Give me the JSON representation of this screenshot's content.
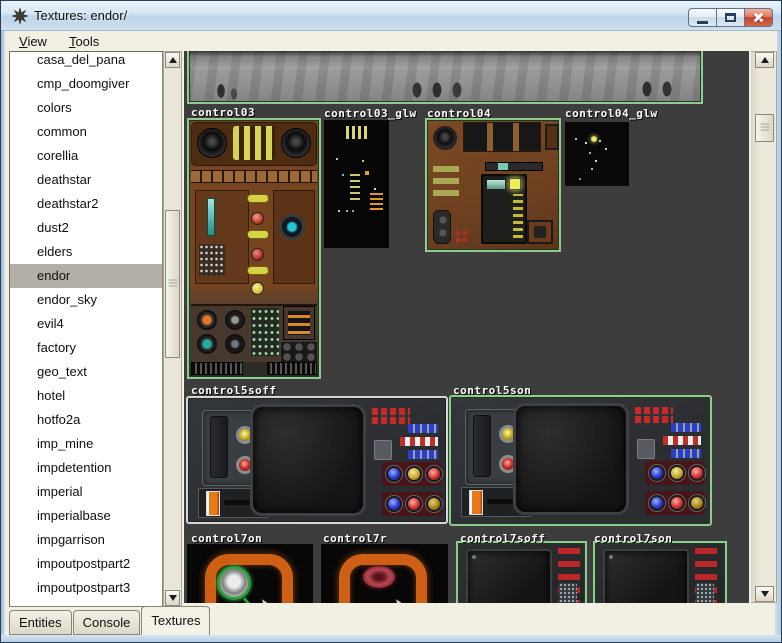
{
  "window": {
    "title": "Textures: endor/",
    "icon": "radiant-star-icon",
    "controls": [
      "minimize",
      "maximize",
      "close"
    ]
  },
  "menubar": {
    "items": [
      {
        "label": "View",
        "underline": "V"
      },
      {
        "label": "Tools",
        "underline": "T"
      }
    ]
  },
  "sidebar": {
    "selected": "endor",
    "items": [
      {
        "label": "casa_del_pana"
      },
      {
        "label": "cmp_doomgiver"
      },
      {
        "label": "colors"
      },
      {
        "label": "common"
      },
      {
        "label": "corellia"
      },
      {
        "label": "deathstar"
      },
      {
        "label": "deathstar2"
      },
      {
        "label": "dust2"
      },
      {
        "label": "elders"
      },
      {
        "label": "endor",
        "selected": true
      },
      {
        "label": "endor_sky"
      },
      {
        "label": "evil4"
      },
      {
        "label": "factory"
      },
      {
        "label": "geo_text"
      },
      {
        "label": "hotel"
      },
      {
        "label": "hotfo2a"
      },
      {
        "label": "imp_mine"
      },
      {
        "label": "impdetention"
      },
      {
        "label": "imperial"
      },
      {
        "label": "imperialbase"
      },
      {
        "label": "impgarrison"
      },
      {
        "label": "impoutpostpart2"
      },
      {
        "label": "impoutpostpart3"
      }
    ]
  },
  "textures": {
    "folder": "endor/",
    "tiles": [
      {
        "id": "strip-top",
        "label": "",
        "style": "tex-wall",
        "x": 3,
        "y": -8,
        "w": 516,
        "h": 61,
        "border": "green",
        "parts": [
          "p-wall-marks"
        ]
      },
      {
        "id": "control03",
        "label": "control03",
        "lx": 7,
        "ly": 55,
        "x": 3,
        "y": 67,
        "w": 134,
        "h": 261,
        "border": "green",
        "style": "tex-c03",
        "parts": [
          "p-c03-top",
          "p-c03-knob-l",
          "p-c03-knob-r",
          "p-c03-slats",
          "p-c03-cells",
          "p-c03-panel-l",
          "p-c03-teal",
          "p-c03-grid",
          "p-c03-pill1",
          "p-c03-dot1",
          "p-c03-pill2",
          "p-c03-dot2",
          "p-c03-pill3",
          "p-c03-dot3",
          "p-c03-panel-r",
          "p-c03-scope",
          "p-c03-low",
          "p-c03-ka",
          "p-c03-kb",
          "p-c03-kc",
          "p-c03-kd",
          "p-c03-ggrid",
          "p-c03-obox",
          "p-c03-circ6",
          "p-c03-vents",
          "p-c03-ventgap"
        ]
      },
      {
        "id": "control03_glw",
        "label": "control03_glw",
        "lx": 140,
        "ly": 56,
        "x": 140,
        "y": 69,
        "w": 65,
        "h": 128,
        "style": "tex-glw3",
        "parts": [
          "p-glw3-slats",
          "p-glw3-sp1",
          "p-glw3-orange",
          "p-glw3-bars"
        ]
      },
      {
        "id": "control04",
        "label": "control04",
        "lx": 243,
        "ly": 56,
        "x": 241,
        "y": 67,
        "w": 136,
        "h": 134,
        "border": "green",
        "style": "tex-c04",
        "parts": [
          "p-c04-knob",
          "p-c04-btnrow",
          "p-c04-btn4",
          "p-c04-bar",
          "p-c04-tags",
          "p-c04-module",
          "p-c04-mscreen",
          "p-c04-ylight",
          "p-c04-mrows",
          "p-c04-side",
          "p-c04-botbox",
          "p-c04-dots"
        ]
      },
      {
        "id": "control04_glw",
        "label": "control04_glw",
        "lx": 381,
        "ly": 56,
        "x": 381,
        "y": 71,
        "w": 64,
        "h": 64,
        "style": "tex-glw4",
        "parts": [
          "p-glw4-sp",
          "p-glw4-center"
        ]
      },
      {
        "id": "control5soff",
        "label": "control5soff",
        "lx": 7,
        "ly": 333,
        "x": 2,
        "y": 345,
        "w": 262,
        "h": 128,
        "border": "gray",
        "style": "tex-c5",
        "parts": [
          "p-c5-tl",
          "p-c5-slot",
          "p-c5-by",
          "p-c5-br",
          "p-c5-lpanel",
          "p-c5-lever",
          "p-c5-lslot",
          "p-c5-screen",
          "p-c5-redgrid",
          "p-c5-chip",
          "p-c5-rb1",
          "p-c5-rw",
          "p-c5-rb2",
          "p-c5-plate1",
          "p-c5-b1",
          "p-c5-b2",
          "p-c5-b3",
          "p-c5-plate2",
          "p-c5-b4",
          "p-c5-b5",
          "p-c5-b6"
        ]
      },
      {
        "id": "control5son",
        "label": "control5son",
        "lx": 269,
        "ly": 333,
        "x": 265,
        "y": 344,
        "w": 263,
        "h": 131,
        "border": "green",
        "style": "tex-c5",
        "parts": [
          "p-c5-tl",
          "p-c5-slot",
          "p-c5-by",
          "p-c5-br",
          "p-c5-lpanel",
          "p-c5-lever",
          "p-c5-lslot",
          "p-c5-screen",
          "p-c5-redgrid",
          "p-c5-chip",
          "p-c5-rb1",
          "p-c5-rw",
          "p-c5-rb2",
          "p-c5-plate1",
          "p-c5-b1",
          "p-c5-b2",
          "p-c5-b3",
          "p-c5-plate2",
          "p-c5-b4",
          "p-c5-b5",
          "p-c5-b6"
        ]
      },
      {
        "id": "control7on",
        "label": "control7on",
        "lx": 7,
        "ly": 481,
        "x": 3,
        "y": 493,
        "w": 126,
        "h": 108,
        "style": "tex-c7on",
        "parts": [
          "p-c7-ring",
          "p-c7-lens",
          "p-c7-stem",
          "p-c7-cursor"
        ]
      },
      {
        "id": "control7r",
        "label": "control7r",
        "lx": 139,
        "ly": 481,
        "x": 137,
        "y": 493,
        "w": 127,
        "h": 108,
        "style": "tex-c7r",
        "parts": [
          "p-c7-ring",
          "p-c7r-oval",
          "p-c7-cursor"
        ]
      },
      {
        "id": "control7soff",
        "label": "control7soff",
        "lx": 276,
        "ly": 481,
        "x": 272,
        "y": 490,
        "w": 131,
        "h": 110,
        "border": "green",
        "style": "tex-c7s",
        "parts": [
          "p-c7s-screen",
          "p-c7s-dot",
          "p-c7s-col"
        ]
      },
      {
        "id": "control7son",
        "label": "control7son",
        "lx": 410,
        "ly": 481,
        "x": 409,
        "y": 490,
        "w": 134,
        "h": 110,
        "border": "green",
        "style": "tex-c7s",
        "parts": [
          "p-c7s-screen",
          "p-c7s-dot",
          "p-c7s-col"
        ]
      }
    ]
  },
  "tabs": [
    {
      "label": "Entities"
    },
    {
      "label": "Console"
    },
    {
      "label": "Textures",
      "active": true
    }
  ],
  "colors": {
    "selected_texture_border_green": "#90ca90",
    "used_texture_border_gray": "#d6d6d6",
    "canvas_background": "#3d3d3d",
    "sidebar_selection_gray": "#b3afa6",
    "titlebar_blue": "#c9dcee",
    "close_button_red": "#c04531",
    "panel_beige": "#f2efe3"
  }
}
